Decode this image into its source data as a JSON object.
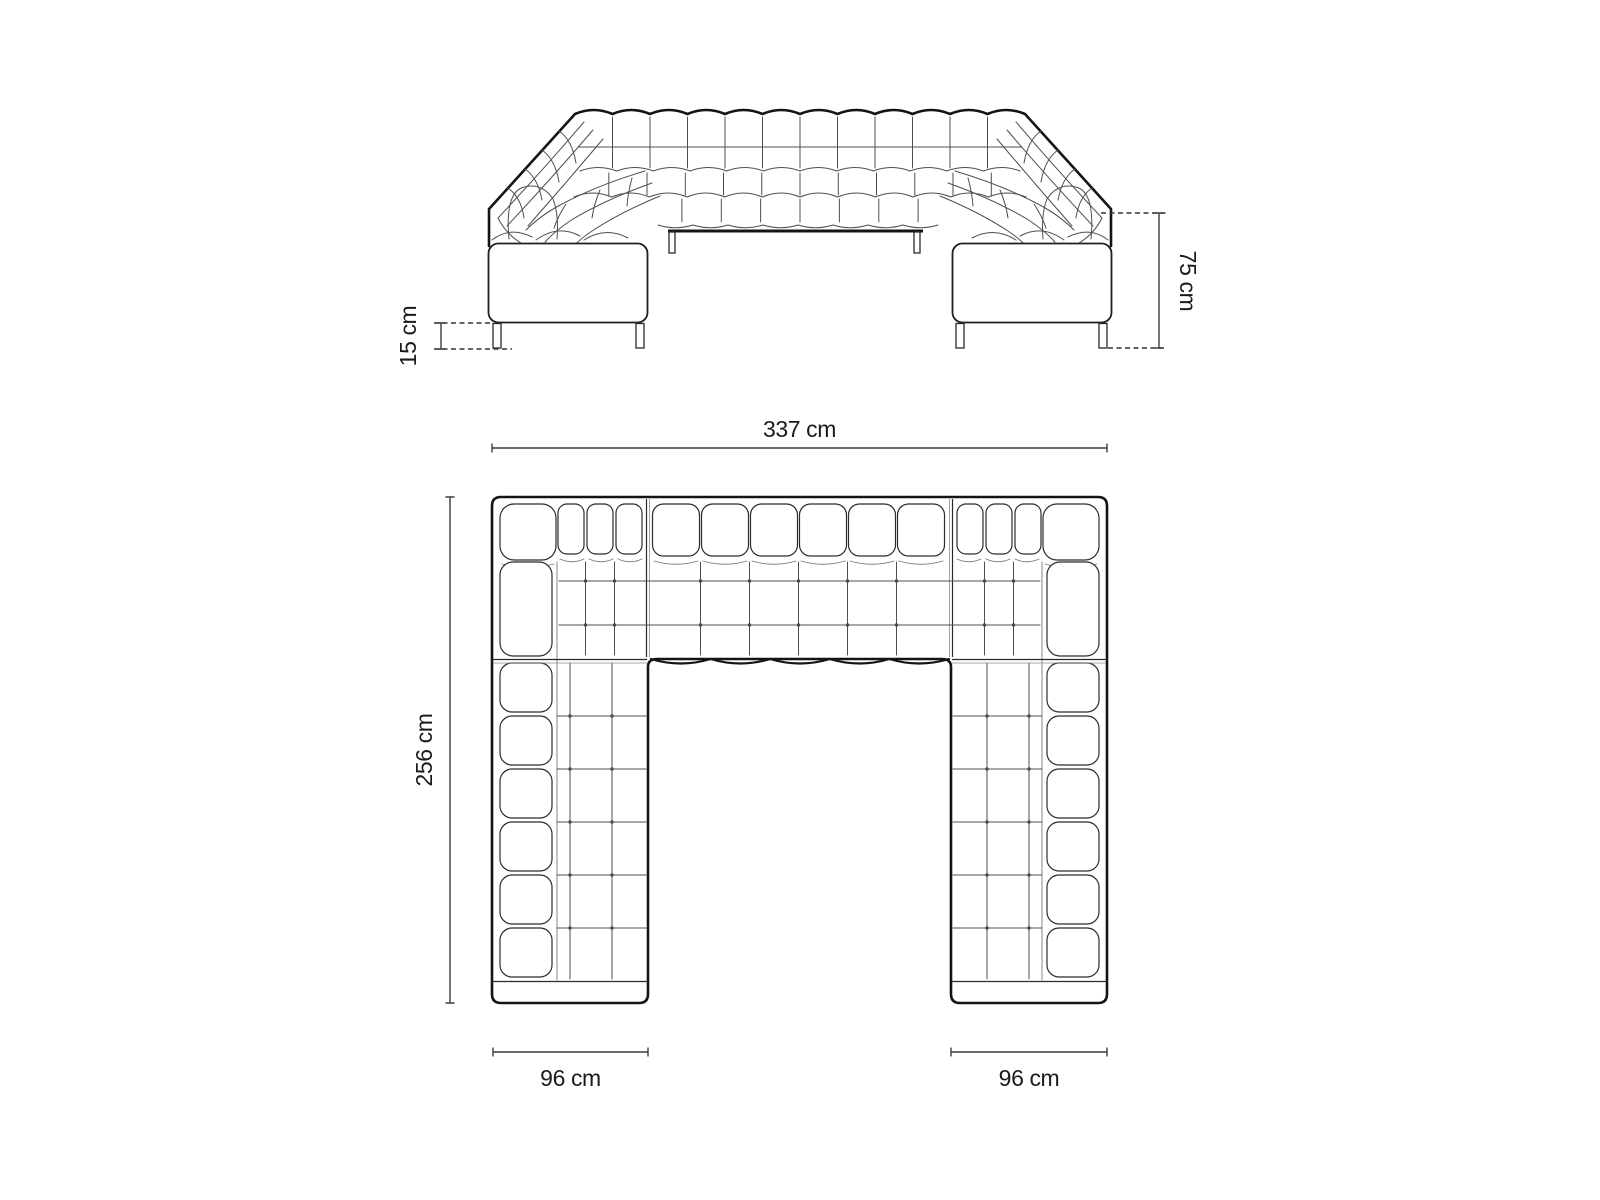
{
  "diagram": {
    "front_view": {
      "leg_height_label": "15 cm",
      "overall_height_label": "75 cm"
    },
    "top_view": {
      "overall_width_label": "337 cm",
      "overall_depth_label": "256 cm",
      "left_arm_width_label": "96 cm",
      "right_arm_width_label": "96 cm"
    },
    "colors": {
      "background": "#ffffff",
      "outline": "#141414",
      "seam_line": "#555555",
      "dimension_line": "#3d3d3d",
      "label_text": "#1b1b1b"
    }
  }
}
